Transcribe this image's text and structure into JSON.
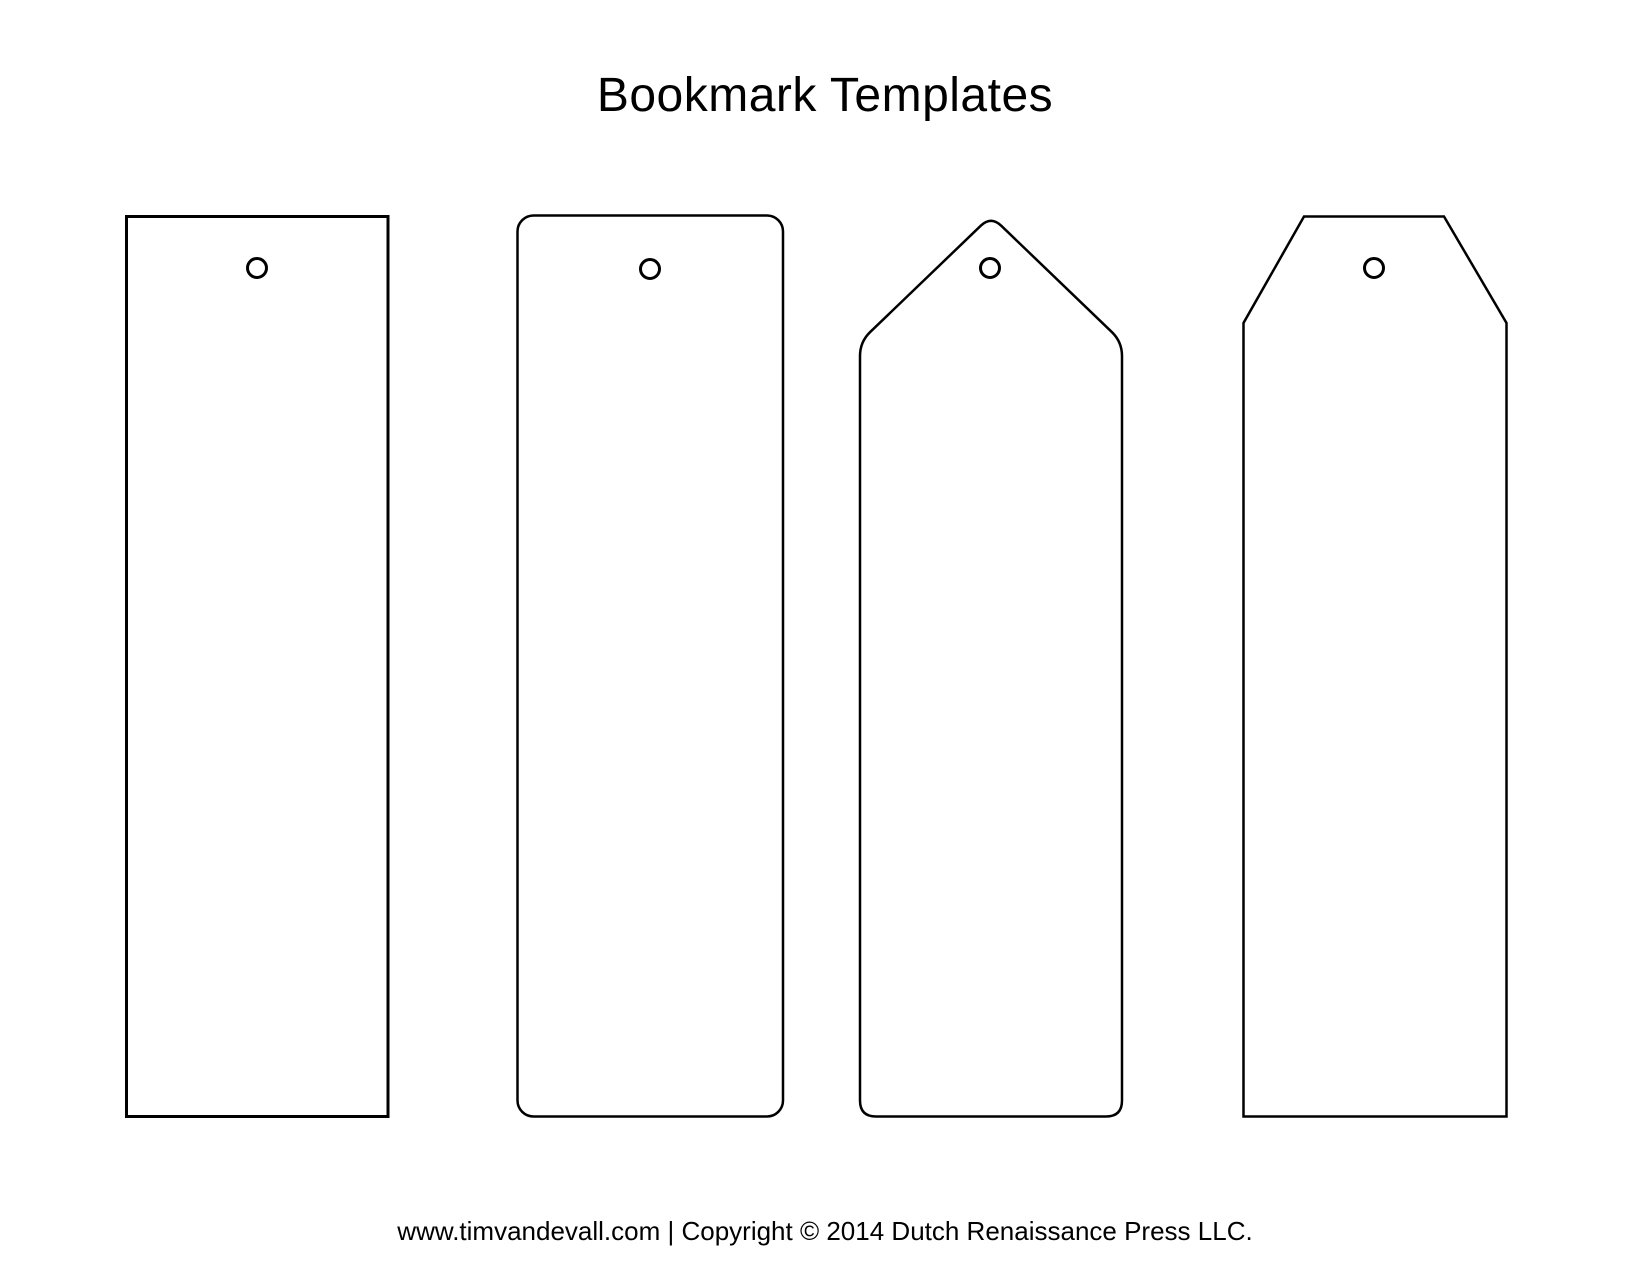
{
  "page": {
    "title": "Bookmark Templates",
    "footer": "www.timvandevall.com | Copyright © 2014 Dutch Renaissance Press LLC.",
    "background_color": "#ffffff",
    "line_color": "#000000"
  },
  "bookmarks": [
    {
      "name": "bookmark-template-rectangle",
      "shape": "rectangle",
      "hole": true
    },
    {
      "name": "bookmark-template-rounded-rectangle",
      "shape": "rounded-rectangle",
      "hole": true
    },
    {
      "name": "bookmark-template-pointed-tag",
      "shape": "pointed-tag",
      "hole": true
    },
    {
      "name": "bookmark-template-angled-tag",
      "shape": "angled-tag",
      "hole": true
    }
  ]
}
